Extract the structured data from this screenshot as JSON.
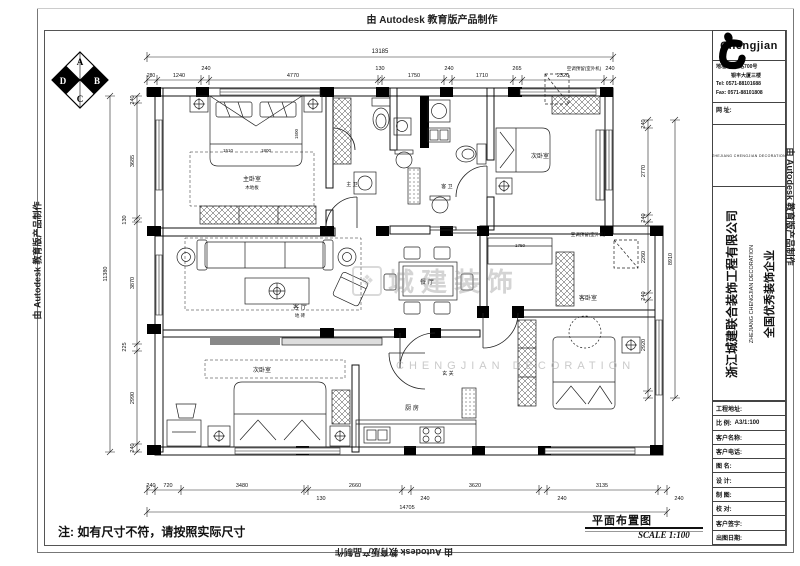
{
  "sheet": {
    "plot_stamp": "由 Autodesk 教育版产品制作",
    "note": "注: 如有尺寸不符，请按照实际尺寸",
    "drawing_title": "平面布置图",
    "scale_label": "SCALE 1:100"
  },
  "title_block": {
    "brand": "Chengjian",
    "address_line1": "地址: 古墩路700号",
    "address_line2": "　　　银丰大厦三楼",
    "tel": "Tel: 0571-88101688",
    "fax": "Fax: 0571-88101808",
    "web_label": "网 址:",
    "logo_caption": "ZHEJIANG CHENGJIAN DECORATION",
    "company_cn": "浙江城建联合装饰工程有限公司",
    "company_en": "ZHEJIANG CHENGJIAN DECORATION",
    "company_honor": "全国优秀装饰企业",
    "rows": [
      {
        "label": "工程地址:",
        "value": ""
      },
      {
        "label": "比 例:",
        "value": "A3/1:100"
      },
      {
        "label": "客户名称:",
        "value": ""
      },
      {
        "label": "客户电话:",
        "value": ""
      },
      {
        "label": "图 名:",
        "value": ""
      },
      {
        "label": "设 计:",
        "value": ""
      },
      {
        "label": "制 图:",
        "value": ""
      },
      {
        "label": "校 对:",
        "value": ""
      },
      {
        "label": "客户签字:",
        "value": ""
      },
      {
        "label": "出图日期:",
        "value": ""
      }
    ]
  },
  "compass": {
    "letters": [
      "A",
      "B",
      "C",
      "D"
    ]
  },
  "watermark": {
    "mark": "❖",
    "text": "城建装饰",
    "sub": "CHENGJIAN DECORATION"
  },
  "plan": {
    "texts": [
      {
        "t": "13185",
        "x": 380,
        "y": 53,
        "s": 6
      },
      {
        "t": "280",
        "x": 151,
        "y": 77,
        "s": 5
      },
      {
        "t": "1240",
        "x": 179,
        "y": 77,
        "s": 5.5
      },
      {
        "t": "240",
        "x": 206,
        "y": 70,
        "s": 5.5
      },
      {
        "t": "4770",
        "x": 293,
        "y": 77,
        "s": 5.5
      },
      {
        "t": "130",
        "x": 380,
        "y": 70,
        "s": 5.5
      },
      {
        "t": "1750",
        "x": 414,
        "y": 77,
        "s": 5.5
      },
      {
        "t": "240",
        "x": 449,
        "y": 70,
        "s": 5.5
      },
      {
        "t": "1710",
        "x": 482,
        "y": 77,
        "s": 5.5
      },
      {
        "t": "265",
        "x": 517,
        "y": 70,
        "s": 5.5
      },
      {
        "t": "2320",
        "x": 563,
        "y": 77,
        "s": 5.5
      },
      {
        "t": "240",
        "x": 610,
        "y": 70,
        "s": 5.5
      },
      {
        "t": "11380",
        "x": 107,
        "y": 274,
        "s": 5.5,
        "r": -90
      },
      {
        "t": "240",
        "x": 134,
        "y": 100,
        "s": 5.5,
        "r": -90
      },
      {
        "t": "3685",
        "x": 134,
        "y": 161,
        "s": 5.5,
        "r": -90
      },
      {
        "t": "130",
        "x": 126,
        "y": 220,
        "s": 5.5,
        "r": -90
      },
      {
        "t": "3870",
        "x": 134,
        "y": 283,
        "s": 5.5,
        "r": -90
      },
      {
        "t": "225",
        "x": 126,
        "y": 347,
        "s": 5.5,
        "r": -90
      },
      {
        "t": "2990",
        "x": 134,
        "y": 398,
        "s": 5.5,
        "r": -90
      },
      {
        "t": "240",
        "x": 134,
        "y": 448,
        "s": 5.5,
        "r": -90
      },
      {
        "t": "240",
        "x": 151,
        "y": 487,
        "s": 5.5
      },
      {
        "t": "720",
        "x": 168,
        "y": 487,
        "s": 5.5
      },
      {
        "t": "3480",
        "x": 242,
        "y": 487,
        "s": 5.5
      },
      {
        "t": "130",
        "x": 321,
        "y": 500,
        "s": 5.5
      },
      {
        "t": "2660",
        "x": 355,
        "y": 487,
        "s": 5.5
      },
      {
        "t": "240",
        "x": 425,
        "y": 500,
        "s": 5.5
      },
      {
        "t": "3620",
        "x": 475,
        "y": 487,
        "s": 5.5
      },
      {
        "t": "240",
        "x": 562,
        "y": 500,
        "s": 5.5
      },
      {
        "t": "3135",
        "x": 602,
        "y": 487,
        "s": 5.5
      },
      {
        "t": "240",
        "x": 679,
        "y": 500,
        "s": 5.5
      },
      {
        "t": "14705",
        "x": 407,
        "y": 509,
        "s": 5.5
      },
      {
        "t": "240",
        "x": 645,
        "y": 124,
        "s": 5.5,
        "r": -90
      },
      {
        "t": "2770",
        "x": 645,
        "y": 171,
        "s": 5.5,
        "r": -90
      },
      {
        "t": "240",
        "x": 645,
        "y": 218,
        "s": 5.5,
        "r": -90
      },
      {
        "t": "2260",
        "x": 645,
        "y": 257,
        "s": 5.5,
        "r": -90
      },
      {
        "t": "240",
        "x": 645,
        "y": 296,
        "s": 5.5,
        "r": -90
      },
      {
        "t": "2920",
        "x": 645,
        "y": 345,
        "s": 5.5,
        "r": -90
      },
      {
        "t": "8910",
        "x": 672,
        "y": 259,
        "s": 5.5,
        "r": -90
      },
      {
        "t": "主卧室",
        "x": 252,
        "y": 181,
        "s": 6
      },
      {
        "t": "木地板",
        "x": 252,
        "y": 189,
        "s": 4.5
      },
      {
        "t": "1510",
        "x": 228,
        "y": 152,
        "s": 4.5
      },
      {
        "t": "1800",
        "x": 266,
        "y": 152,
        "s": 4.5
      },
      {
        "t": "1500",
        "x": 298,
        "y": 134,
        "s": 4.5,
        "r": -90
      },
      {
        "t": "客 厅",
        "x": 300,
        "y": 309,
        "s": 6
      },
      {
        "t": "地 砖",
        "x": 300,
        "y": 317,
        "s": 4.5
      },
      {
        "t": "餐 厅",
        "x": 427,
        "y": 284,
        "s": 6
      },
      {
        "t": "厨 房",
        "x": 412,
        "y": 410,
        "s": 6
      },
      {
        "t": "主 卫",
        "x": 352,
        "y": 186,
        "s": 5
      },
      {
        "t": "客 卫",
        "x": 447,
        "y": 188,
        "s": 5
      },
      {
        "t": "次卧室",
        "x": 540,
        "y": 158,
        "s": 6
      },
      {
        "t": "次卧室",
        "x": 262,
        "y": 372,
        "s": 6
      },
      {
        "t": "客卧室",
        "x": 588,
        "y": 300,
        "s": 6
      },
      {
        "t": "玄 关",
        "x": 448,
        "y": 375,
        "s": 5
      },
      {
        "t": "空调预留(室外机)",
        "x": 584,
        "y": 70,
        "s": 4.5
      },
      {
        "t": "空调预留(室外机)",
        "x": 588,
        "y": 236,
        "s": 4.5
      },
      {
        "t": "1750",
        "x": 520,
        "y": 247,
        "s": 4.5
      }
    ],
    "dim_chains": [
      {
        "o": "h",
        "y": 57,
        "ticks": [
          147,
          613
        ]
      },
      {
        "o": "h",
        "y": 80,
        "ticks": [
          147,
          157,
          201,
          209,
          378,
          382,
          444,
          452,
          513,
          522,
          604,
          613
        ]
      },
      {
        "o": "h",
        "y": 490,
        "ticks": [
          147,
          155,
          181,
          304,
          308,
          402,
          411,
          539,
          547,
          658,
          667
        ]
      },
      {
        "o": "h",
        "y": 512,
        "ticks": [
          147,
          667
        ]
      },
      {
        "o": "v",
        "x": 110,
        "ticks": [
          96,
          452
        ]
      },
      {
        "o": "v",
        "x": 137,
        "ticks": [
          96,
          103,
          218,
          222,
          344,
          351,
          444,
          452
        ]
      },
      {
        "o": "v",
        "x": 648,
        "ticks": [
          120,
          128,
          215,
          222,
          293,
          300,
          391,
          398
        ]
      },
      {
        "o": "v",
        "x": 675,
        "ticks": [
          120,
          398
        ]
      }
    ]
  }
}
